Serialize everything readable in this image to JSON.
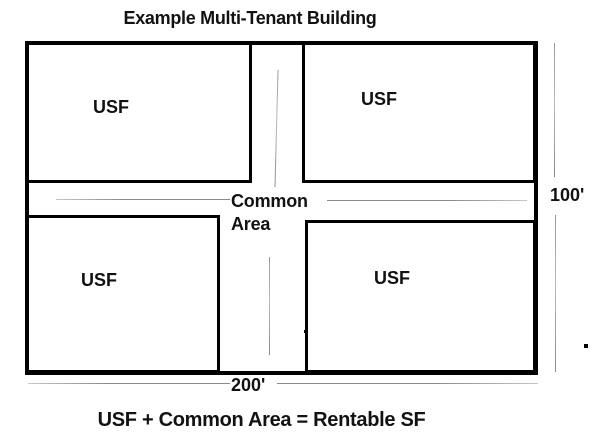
{
  "title": "Example Multi-Tenant Building",
  "units": [
    {
      "position": "top-left",
      "label": "USF"
    },
    {
      "position": "top-right",
      "label": "USF"
    },
    {
      "position": "bottom-left",
      "label": "USF"
    },
    {
      "position": "bottom-right",
      "label": "USF"
    }
  ],
  "common_area": {
    "line1": "Common",
    "line2": "Area"
  },
  "dimensions": {
    "building_depth": "100'",
    "building_width": "200'"
  },
  "formula": "USF + Common Area = Rentable SF",
  "colors": {
    "background": "#ffffff",
    "outline": "#000000",
    "text": "#121212",
    "dimension_line": "#8f8f8f"
  }
}
